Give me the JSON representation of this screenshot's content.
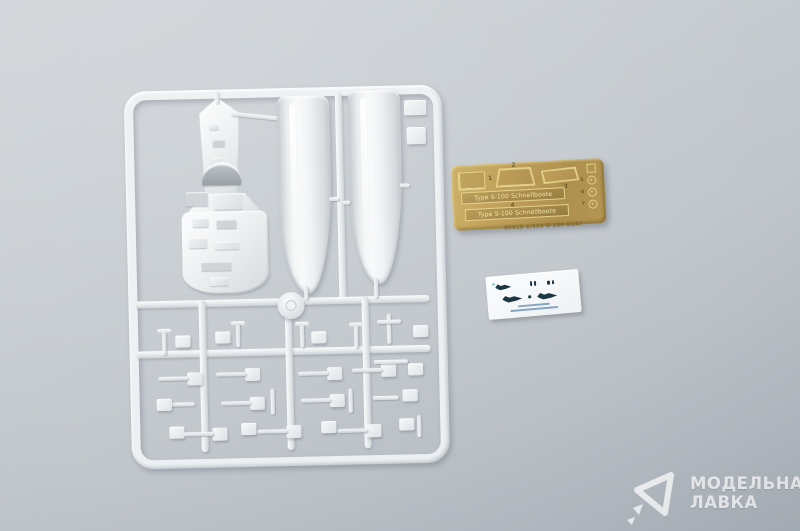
{
  "photo": {
    "subject": "Plastic model kit contents: styrene sprue with boat hull parts, brass photo-etched fret and decal sheet on a gray background",
    "background_color": "#c4cacf",
    "plastic_color": "#eef1f3",
    "brass_color": "#b6954d"
  },
  "photo_etch": {
    "nameplate_top": "Type S-100 Schnellboote",
    "nameplate_bottom": "Type S-100 Schnellboote",
    "footer": "06615 1/350 S-100 BOAT",
    "part_numbers": [
      "1",
      "2",
      "3",
      "4",
      "5",
      "6",
      "7"
    ]
  },
  "watermark": {
    "line1": "МОДЕЛЬНАЯ",
    "line2": "ЛАВКА"
  }
}
